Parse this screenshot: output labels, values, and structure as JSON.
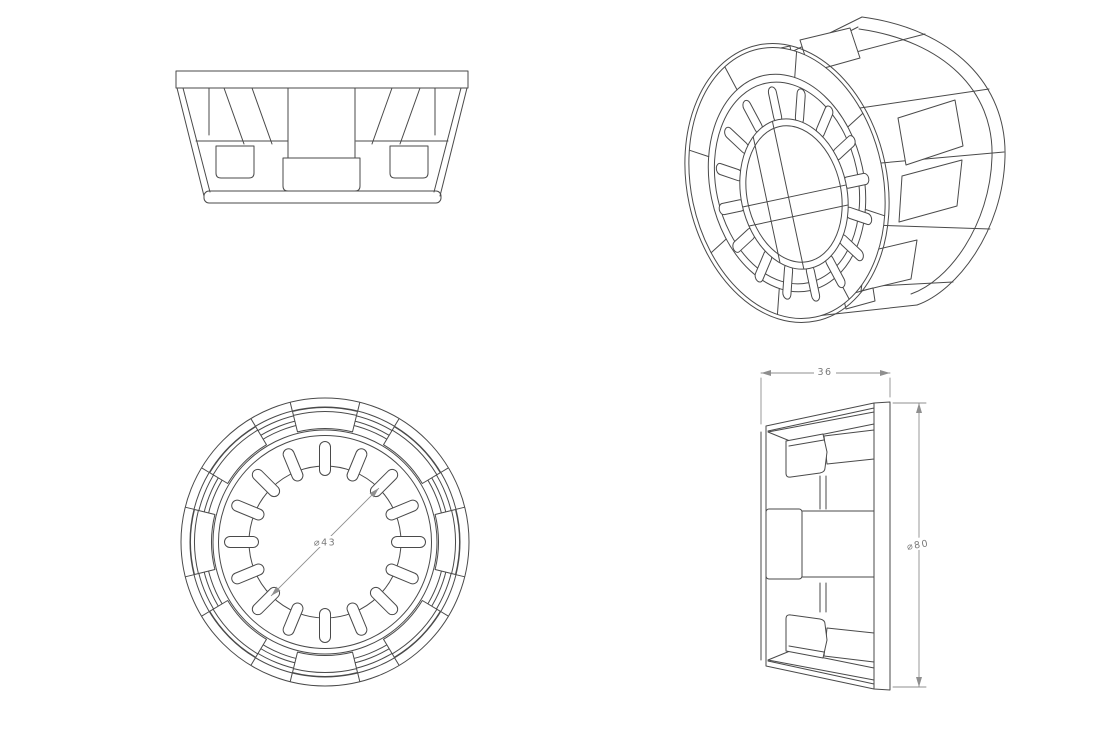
{
  "canvas": {
    "background": "#ffffff",
    "part_line_color": "#4a4a4a",
    "dimension_color": "#8f8f8f"
  },
  "dimensions": {
    "side_width": "36",
    "side_outer_diameter": "⌀80",
    "front_inner_diameter": "⌀43"
  }
}
